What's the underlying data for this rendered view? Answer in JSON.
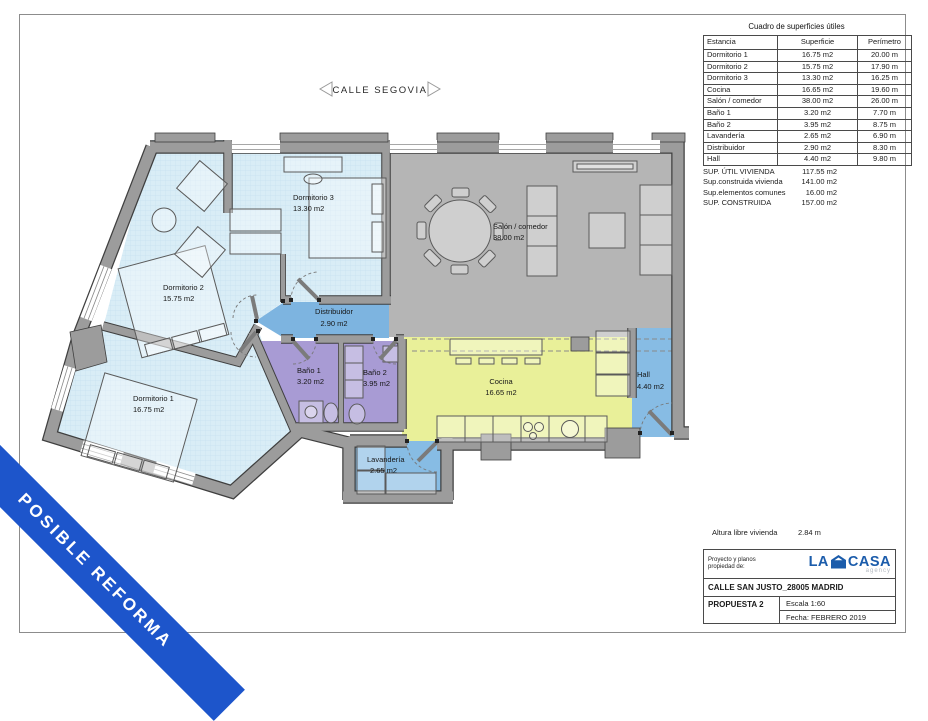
{
  "street": {
    "label": "CALLE SEGOVIA"
  },
  "ribbon": {
    "label": "POSIBLE REFORMA"
  },
  "surface_table": {
    "title": "Cuadro de superficies útiles",
    "columns": [
      "Estancia",
      "Superficie",
      "Perímetro"
    ],
    "rows": [
      [
        "Dormitorio 1",
        "16.75 m2",
        "20.00 m"
      ],
      [
        "Dormitorio 2",
        "15.75 m2",
        "17.90 m"
      ],
      [
        "Dormitorio 3",
        "13.30 m2",
        "16.25 m"
      ],
      [
        "Cocina",
        "16.65 m2",
        "19.60 m"
      ],
      [
        "Salón / comedor",
        "38.00 m2",
        "26.00 m"
      ],
      [
        "Baño 1",
        "3.20 m2",
        "7.70 m"
      ],
      [
        "Baño 2",
        "3.95 m2",
        "8.75 m"
      ],
      [
        "Lavandería",
        "2.65 m2",
        "6.90 m"
      ],
      [
        "Distribuidor",
        "2.90 m2",
        "8.30 m"
      ],
      [
        "Hall",
        "4.40 m2",
        "9.80 m"
      ]
    ]
  },
  "summary": {
    "rows": [
      {
        "label": "SUP. ÚTIL VIVIENDA",
        "value": "117.55 m2"
      },
      {
        "label": "Sup.construida vivienda",
        "value": "141.00 m2"
      },
      {
        "label": "Sup.elementos comunes",
        "value": "16.00 m2"
      },
      {
        "label": "SUP. CONSTRUIDA",
        "value": "157.00 m2"
      }
    ]
  },
  "height_note": {
    "label": "Altura libre vivienda",
    "value": "2.84 m"
  },
  "title_block": {
    "ownership_label": "Proyecto y planos propiedad de:",
    "brand": {
      "word1": "LA",
      "word2": "CASA",
      "sub": "agency"
    },
    "address": "CALLE SAN JUSTO_28005 MADRID",
    "proposal": "PROPUESTA 2",
    "scale": "Escala 1:60",
    "date": "Fecha: FEBRERO 2019"
  },
  "plan": {
    "rooms": [
      {
        "name": "Dormitorio 1",
        "area": "16.75 m2"
      },
      {
        "name": "Dormitorio 2",
        "area": "15.75 m2"
      },
      {
        "name": "Dormitorio 3",
        "area": "13.30 m2"
      },
      {
        "name": "Cocina",
        "area": "16.65 m2"
      },
      {
        "name": "Salón / comedor",
        "area": "38.00 m2"
      },
      {
        "name": "Baño 1",
        "area": "3.20 m2"
      },
      {
        "name": "Baño 2",
        "area": "3.95 m2"
      },
      {
        "name": "Lavandería",
        "area": "2.65 m2"
      },
      {
        "name": "Distribuidor",
        "area": "2.90 m2"
      },
      {
        "name": "Hall",
        "area": "4.40 m2"
      }
    ],
    "colors": {
      "bedroom": "#d9edf6",
      "salon": "#b5b5b5",
      "cocina": "#e9f099",
      "bano": "#a89bd4",
      "hall": "#87bce4",
      "distribuidor": "#7db4e0",
      "wall": "#9c9c9c",
      "ribbon_blue": "#1d55cb",
      "brand_blue": "#1b5cab"
    }
  }
}
